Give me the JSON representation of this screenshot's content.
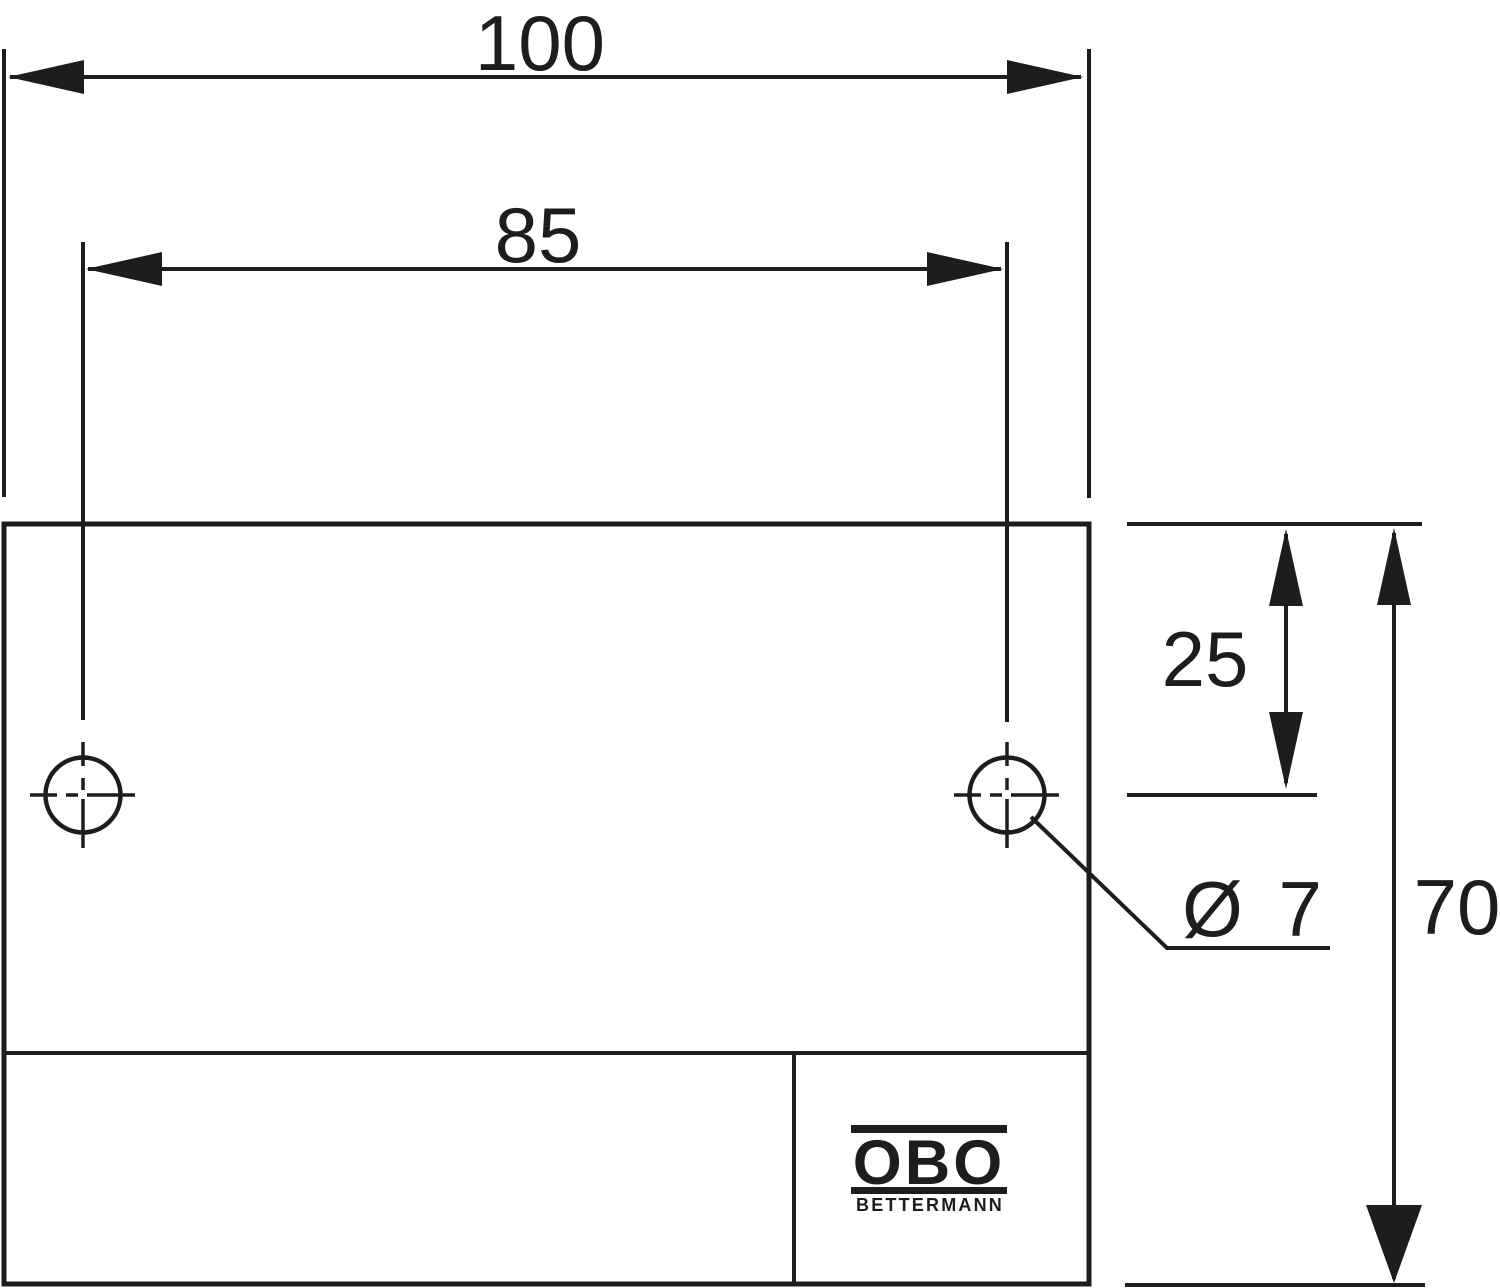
{
  "drawing": {
    "type": "dimension-drawing",
    "labels": {
      "dim_width": "100",
      "dim_hole_spacing": "85",
      "dim_hole_offset": "25",
      "dim_height": "70",
      "dim_hole_diameter": "Ø 7"
    },
    "logo": {
      "brand": "OBO",
      "name": "BETTERMANN"
    },
    "colors": {
      "ink": "#1d1d1b",
      "paper": "#ffffff"
    }
  }
}
